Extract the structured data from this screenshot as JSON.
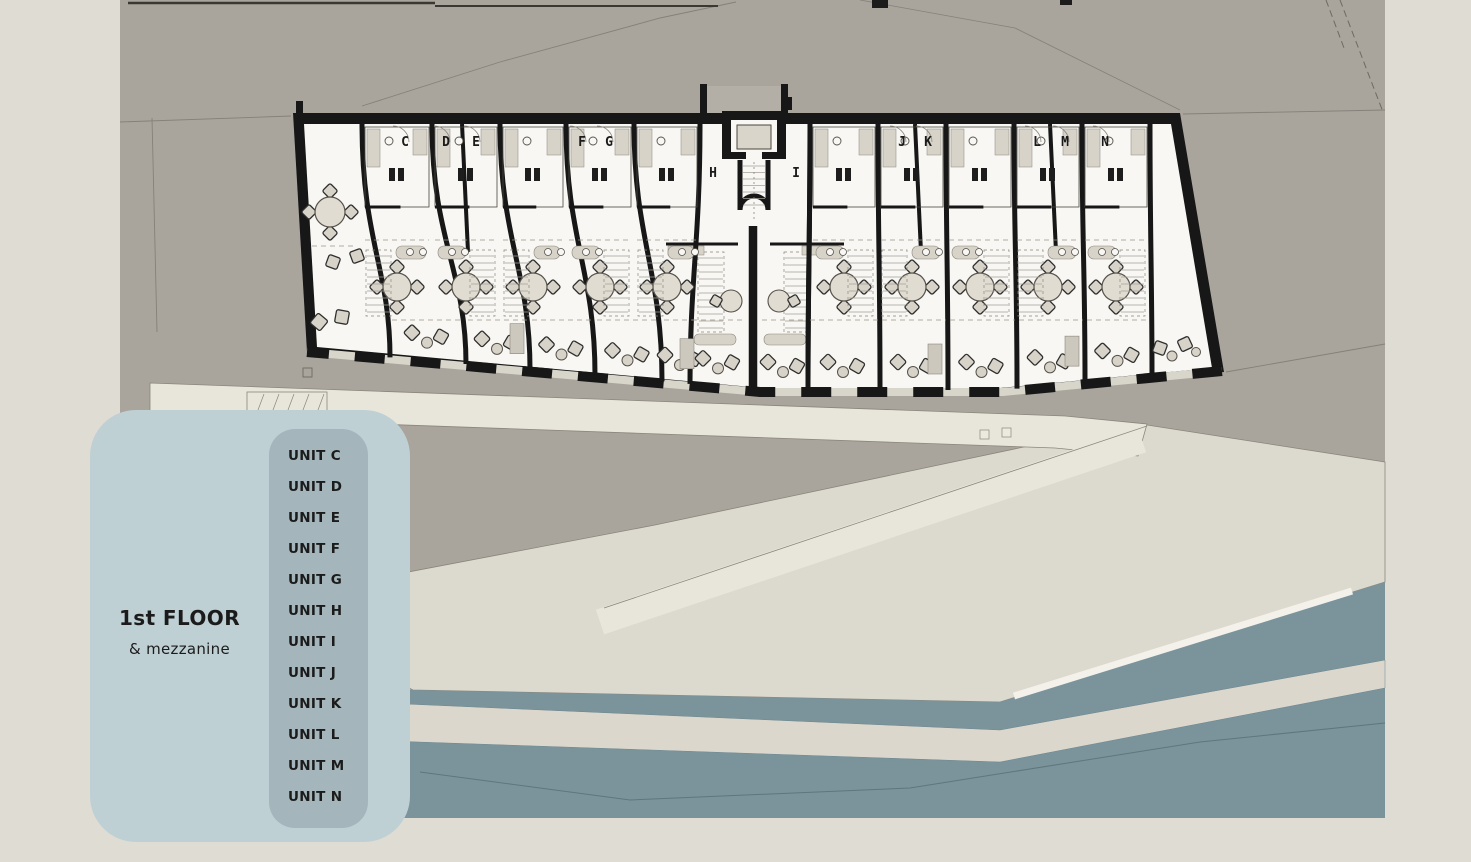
{
  "legend": {
    "floor": "1st FLOOR",
    "mezzanine": "& mezzanine",
    "units": [
      "UNIT C",
      "UNIT D",
      "UNIT E",
      "UNIT F",
      "UNIT G",
      "UNIT H",
      "UNIT I",
      "UNIT J",
      "UNIT K",
      "UNIT L",
      "UNIT M",
      "UNIT N"
    ]
  },
  "plan": {
    "unit_letters": [
      "C",
      "D",
      "E",
      "F",
      "G",
      "H",
      "I",
      "J",
      "K",
      "L",
      "M",
      "N"
    ]
  },
  "palette": {
    "page_bg": "#dfdcd3",
    "ground": "#a9a59d",
    "paving": "#dcd9ce",
    "walkway": "#e8e5db",
    "water": "#7b939b",
    "breakwater": "#dbd7cc",
    "pontoon": "#f3f1ea",
    "wall": "#171717",
    "interior": "#f8f7f3",
    "furniture": "#d7d3c8",
    "furniture_line": "#56524b",
    "detail_line": "#8a867d",
    "legend_panel": "#bfd0d5",
    "legend_inner": "#a4b6bb",
    "text_dark": "#1b1b1b"
  }
}
